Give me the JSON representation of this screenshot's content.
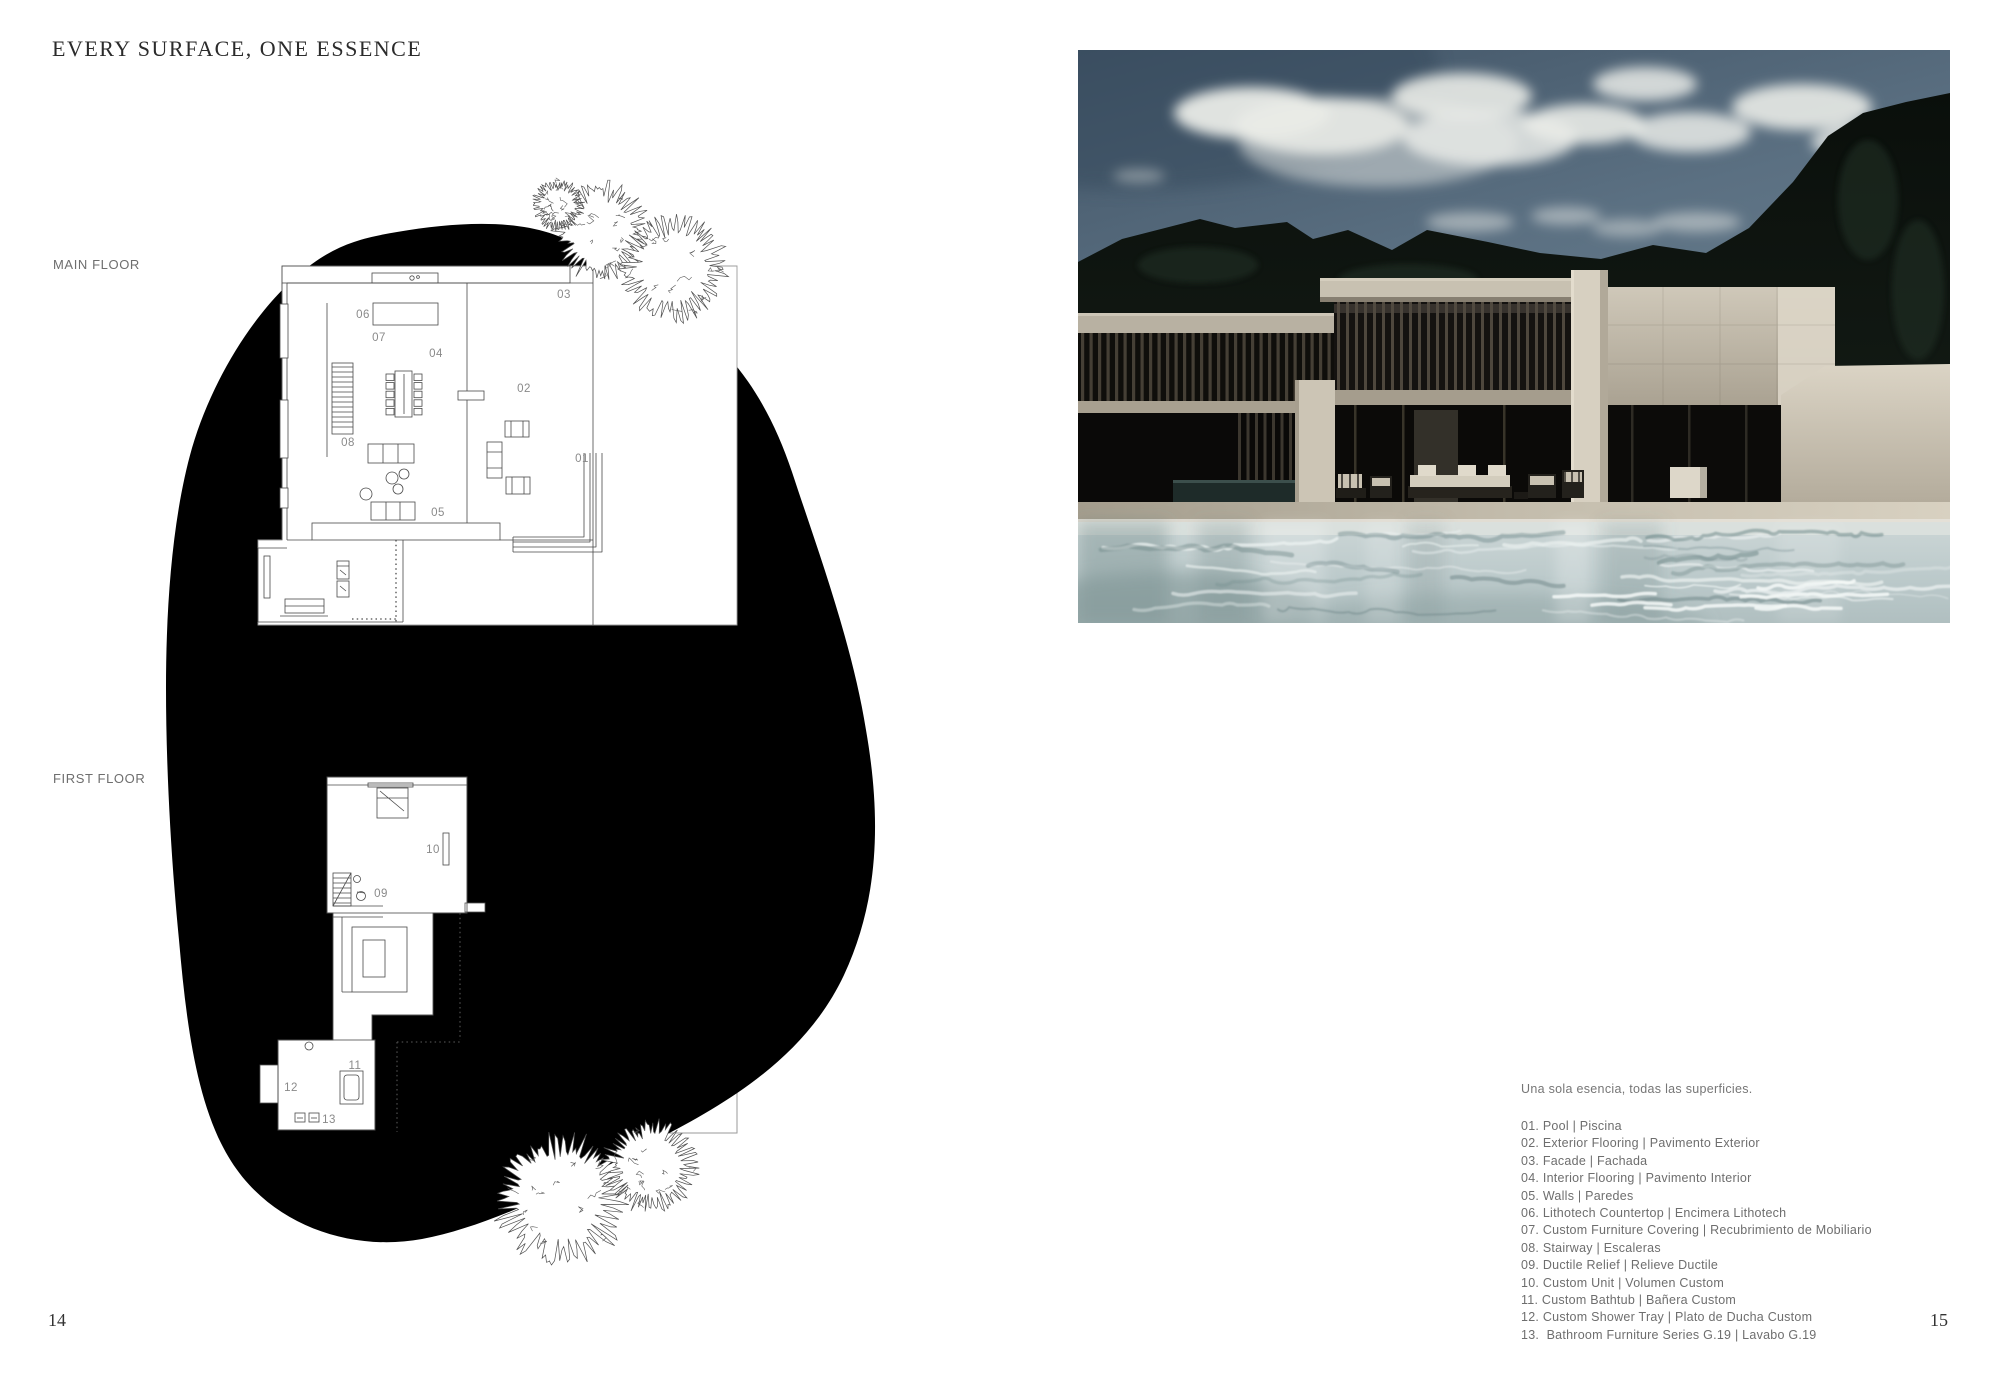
{
  "page": {
    "title": "EVERY SURFACE, ONE ESSENCE",
    "left_number": "14",
    "right_number": "15"
  },
  "floor_labels": {
    "main": "MAIN FLOOR",
    "first": "FIRST FLOOR"
  },
  "legend": {
    "caption": "Una sola esencia, todas las superficies.",
    "items": [
      "01. Pool | Piscina",
      "02. Exterior Flooring | Pavimento Exterior",
      "03. Facade | Fachada",
      "04. Interior Flooring | Pavimento Interior",
      "05. Walls | Paredes",
      "06. Lithotech Countertop | Encimera Lithotech",
      "07. Custom Furniture Covering | Recubrimiento de Mobiliario",
      "08. Stairway | Escaleras",
      "09. Ductile Relief | Relieve Ductile",
      "10. Custom Unit | Volumen Custom",
      "11. Custom Bathtub | Bañera Custom",
      "12. Custom Shower Tray | Plato de Ducha Custom",
      "13.  Bathroom Furniture Series G.19 | Lavabo G.19"
    ]
  },
  "plan_callouts": {
    "main": [
      {
        "n": "06",
        "x": 363,
        "y": 318
      },
      {
        "n": "07",
        "x": 379,
        "y": 341
      },
      {
        "n": "04",
        "x": 436,
        "y": 357
      },
      {
        "n": "03",
        "x": 564,
        "y": 298
      },
      {
        "n": "02",
        "x": 524,
        "y": 392
      },
      {
        "n": "08",
        "x": 348,
        "y": 446
      },
      {
        "n": "01",
        "x": 582,
        "y": 462
      },
      {
        "n": "05",
        "x": 438,
        "y": 516
      }
    ],
    "first": [
      {
        "n": "10",
        "x": 433,
        "y": 853
      },
      {
        "n": "09",
        "x": 381,
        "y": 897
      },
      {
        "n": "11",
        "x": 355,
        "y": 1069
      },
      {
        "n": "12",
        "x": 291,
        "y": 1091
      },
      {
        "n": "13",
        "x": 329,
        "y": 1123
      }
    ]
  },
  "colors": {
    "ink": "#000000",
    "plan_line": "#4a4a4a",
    "callout_gray": "#8a8a8a",
    "text_gray": "#6e6e6e",
    "sky": "#54687a",
    "water": "#c3ced0",
    "concrete": "#c9c2b2",
    "tree_dark": "#0c110d"
  }
}
